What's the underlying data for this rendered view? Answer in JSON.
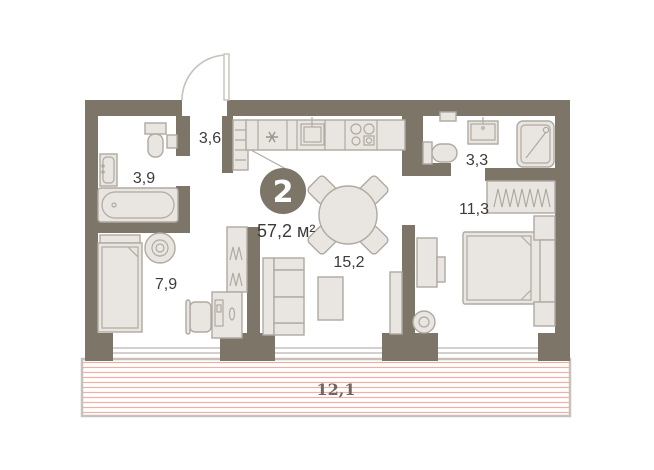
{
  "plan": {
    "badge": {
      "rooms_count": "2",
      "total_area": "57,2 м²"
    },
    "rooms": [
      {
        "name": "hallway",
        "area": "3,6"
      },
      {
        "name": "bathroom",
        "area": "3,9"
      },
      {
        "name": "room-small",
        "area": "7,9"
      },
      {
        "name": "kitchen-living-room",
        "area": "15,2"
      },
      {
        "name": "bathroom-2",
        "area": "3,3"
      },
      {
        "name": "bedroom",
        "area": "11,3"
      },
      {
        "name": "balcony",
        "area": "12,1"
      }
    ],
    "icons": [
      "bathtub-icon",
      "toilet-icon",
      "sink-icon",
      "fridge-snowflake-icon",
      "stove-icon",
      "kitchen-sink-icon",
      "dining-table-icon",
      "chair-icon",
      "sofa-icon",
      "coffee-table-icon",
      "bed-icon",
      "pouf-icon",
      "desk-icon",
      "computer-icon",
      "wardrobe-hangers-icon",
      "shower-icon",
      "tv-stand-icon",
      "plant-icon",
      "entrance-door-icon",
      "window-icon"
    ],
    "colors": {
      "wall": "#7d7568",
      "furn_fill": "#e9e6e1",
      "furn_stroke": "#afa9a0",
      "thin": "#c6c1ba",
      "label": "#3e3c39",
      "hatch": "#f0afa2",
      "badge_fill": "#7d7568",
      "badge_text": "#ffffff",
      "balcony_label": "#6f6862"
    }
  }
}
